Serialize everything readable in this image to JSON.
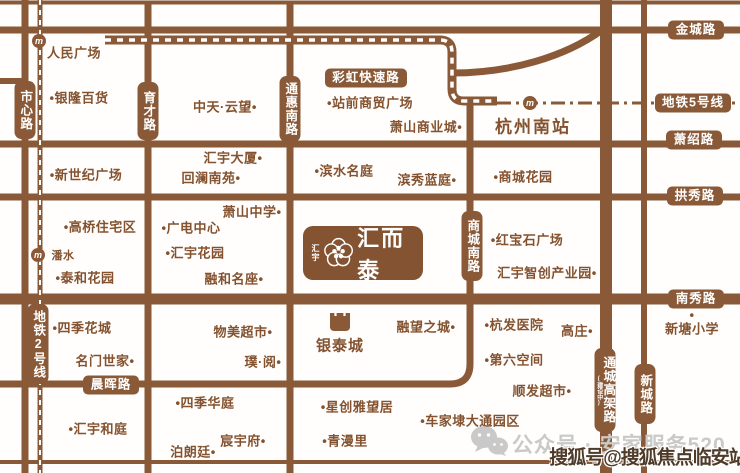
{
  "colors": {
    "road": "#8a5a38",
    "label_text": "#84522e",
    "badge_bg": "#8a5a38",
    "badge_text": "#ffffff",
    "plaque_bg": "#845331",
    "watermark_gray": "#c9c9c9",
    "watermark_sohu": "#4f3b29"
  },
  "logo": {
    "side_text": "汇宇",
    "title": "汇而泰"
  },
  "road_badges": [
    {
      "text": "金城路",
      "x": 696,
      "y": 30,
      "dir": "h",
      "w": 56
    },
    {
      "text": "彩虹快速路",
      "x": 366,
      "y": 78,
      "dir": "h",
      "w": 82
    },
    {
      "text": "地铁5号线",
      "x": 693,
      "y": 103,
      "dir": "h",
      "w": 76
    },
    {
      "text": "萧绍路",
      "x": 694,
      "y": 140,
      "dir": "h",
      "w": 56
    },
    {
      "text": "拱秀路",
      "x": 695,
      "y": 196,
      "dir": "h",
      "w": 56
    },
    {
      "text": "南秀路",
      "x": 696,
      "y": 299,
      "dir": "h",
      "w": 56
    },
    {
      "text": "晨晖路",
      "x": 111,
      "y": 385,
      "dir": "h",
      "w": 56
    },
    {
      "text": "市心路",
      "x": 25,
      "y": 110,
      "dir": "v",
      "h": 58
    },
    {
      "text": "育才路",
      "x": 148,
      "y": 111,
      "dir": "v",
      "h": 58
    },
    {
      "text": "通惠南路",
      "x": 290,
      "y": 109,
      "dir": "v",
      "h": 66
    },
    {
      "text": "商城南路",
      "x": 472,
      "y": 246,
      "dir": "v",
      "h": 70
    },
    {
      "text": "地铁2号线",
      "x": 38,
      "y": 344,
      "dir": "v",
      "h": 80
    },
    {
      "text": "通城高架路",
      "x": 605,
      "y": 390,
      "dir": "v",
      "h": 84,
      "sub": "(建设中)"
    },
    {
      "text": "新城路",
      "x": 645,
      "y": 394,
      "dir": "v",
      "h": 60
    }
  ],
  "landmarks": [
    {
      "text": "人民广场",
      "x": 74,
      "y": 52
    },
    {
      "text": "•银隆百货",
      "x": 79,
      "y": 97
    },
    {
      "text": "中天·云望•",
      "x": 225,
      "y": 106
    },
    {
      "text": "•站前商贸广场",
      "x": 370,
      "y": 102
    },
    {
      "text": "萧山商业城•",
      "x": 426,
      "y": 126
    },
    {
      "text": "杭州南站",
      "x": 533,
      "y": 125,
      "cls": "big"
    },
    {
      "text": "•新世纪广场",
      "x": 86,
      "y": 174
    },
    {
      "text": "汇宇大厦•",
      "x": 233,
      "y": 157
    },
    {
      "text": "回澜南苑•",
      "x": 211,
      "y": 177
    },
    {
      "text": "•滨水名庭",
      "x": 344,
      "y": 170
    },
    {
      "text": "滨秀蓝庭•",
      "x": 427,
      "y": 179
    },
    {
      "text": "•商城花园",
      "x": 523,
      "y": 176
    },
    {
      "text": "萧山中学•",
      "x": 252,
      "y": 211
    },
    {
      "text": "•高桥住宅区",
      "x": 100,
      "y": 226
    },
    {
      "text": "•广电中心",
      "x": 191,
      "y": 227
    },
    {
      "text": "•汇宇花园",
      "x": 195,
      "y": 252
    },
    {
      "text": "•红宝石广场",
      "x": 527,
      "y": 239
    },
    {
      "text": "潘水",
      "x": 63,
      "y": 255,
      "cls": "small"
    },
    {
      "text": "•泰和花园",
      "x": 85,
      "y": 277
    },
    {
      "text": "融和名座•",
      "x": 234,
      "y": 278
    },
    {
      "text": "汇宇智创产业园•",
      "x": 547,
      "y": 272
    },
    {
      "text": "•四季花城",
      "x": 82,
      "y": 327
    },
    {
      "text": "物美超市•",
      "x": 243,
      "y": 331
    },
    {
      "text": "银泰城",
      "x": 340,
      "y": 345,
      "cls": "mid"
    },
    {
      "text": "融望之城•",
      "x": 426,
      "y": 326
    },
    {
      "text": "•杭发医院",
      "x": 514,
      "y": 324
    },
    {
      "text": "高庄•",
      "x": 577,
      "y": 330
    },
    {
      "text": "•",
      "x": 692,
      "y": 315
    },
    {
      "text": "新塘小学",
      "x": 692,
      "y": 328
    },
    {
      "text": "名门世家•",
      "x": 105,
      "y": 360
    },
    {
      "text": "璞·阅•",
      "x": 263,
      "y": 361
    },
    {
      "text": "•第六空间",
      "x": 514,
      "y": 359
    },
    {
      "text": "顺发超市•",
      "x": 542,
      "y": 390
    },
    {
      "text": "•四季华庭",
      "x": 205,
      "y": 402
    },
    {
      "text": "•星创雅望居",
      "x": 357,
      "y": 406
    },
    {
      "text": "•车家埭大通园区",
      "x": 470,
      "y": 420
    },
    {
      "text": "•汇宇和庭",
      "x": 98,
      "y": 428
    },
    {
      "text": "•青漫里",
      "x": 345,
      "y": 440
    },
    {
      "text": "宸宇府•",
      "x": 243,
      "y": 440
    },
    {
      "text": "泊朗廷•",
      "x": 193,
      "y": 451
    }
  ],
  "metro_stations": [
    {
      "x": 39,
      "y": 41
    },
    {
      "x": 530,
      "y": 103
    },
    {
      "x": 38,
      "y": 255
    }
  ],
  "watermarks": {
    "wechat": "公众号 · 安家服务520",
    "sohu": "搜狐号@搜狐焦点临安站"
  }
}
